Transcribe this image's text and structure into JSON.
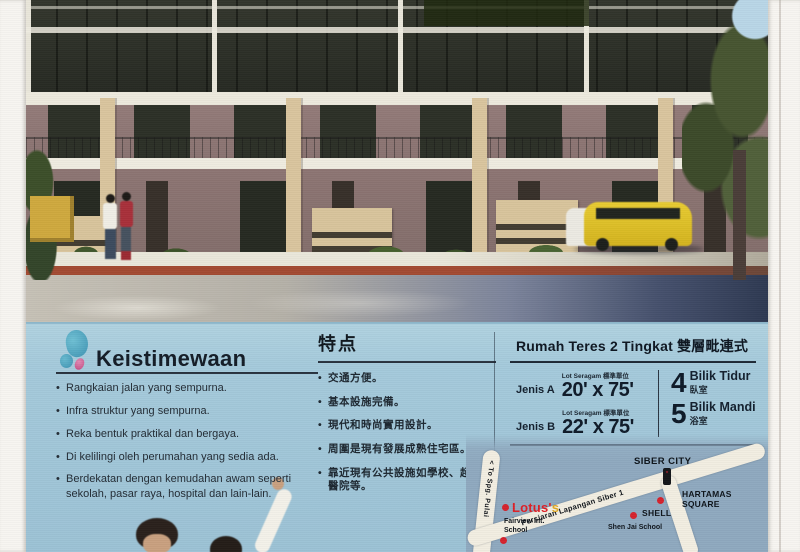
{
  "features_ms": {
    "heading": "Keistimewaan",
    "bullets": [
      "Rangkaian jalan yang sempurna.",
      "Infra struktur yang sempurna.",
      "Reka bentuk praktikal dan bergaya.",
      "Di kelilingi oleh perumahan yang sedia ada.",
      "Berdekatan dengan kemudahan awam seperti sekolah, pasar raya, hospital dan lain-lain."
    ]
  },
  "features_zh": {
    "heading": "特点",
    "bullets": [
      "交通方便。",
      "基本設施完備。",
      "現代和時尚實用設計。",
      "周圍是現有發展成熟住宅區。",
      "靠近現有公共設施如學校、超市、醫院等。"
    ]
  },
  "spec": {
    "heading": "Rumah Teres 2 Tingkat 雙層毗連式",
    "rows": [
      {
        "label": "Jenis A",
        "lot_note": "Lot Seragam 標準單位",
        "size": "20' x 75'"
      },
      {
        "label": "Jenis B",
        "lot_note": "Lot Seragam 標準單位",
        "size": "22' x 75'"
      }
    ],
    "counts": [
      {
        "number": "4",
        "label": "Bilik Tidur",
        "label_zh": "臥室"
      },
      {
        "number": "5",
        "label": "Bilik Mandi",
        "label_zh": "浴室"
      }
    ]
  },
  "map": {
    "labels": {
      "siber_city": "SIBER CITY",
      "hartamas_square": "HARTAMAS SQUARE",
      "lotus_main": "Lotus'",
      "lotus_suffix": "s",
      "fairview": "Fairview Int. School",
      "shell": "SHELL",
      "shen_jai": "Shen Jai School",
      "road_diagonal": "Persiaran Lapangan Siber 1",
      "road_to": "< To Spg. Pulai"
    }
  },
  "colors": {
    "panel_blue": "#a5cadb",
    "map_blue": "#8fa9bf",
    "road_cream": "#f2eee1",
    "marker_red": "#d5232d",
    "lotus_red": "#dd1f26",
    "lotus_gold": "#e0a823",
    "text_dark": "#1b242e"
  }
}
